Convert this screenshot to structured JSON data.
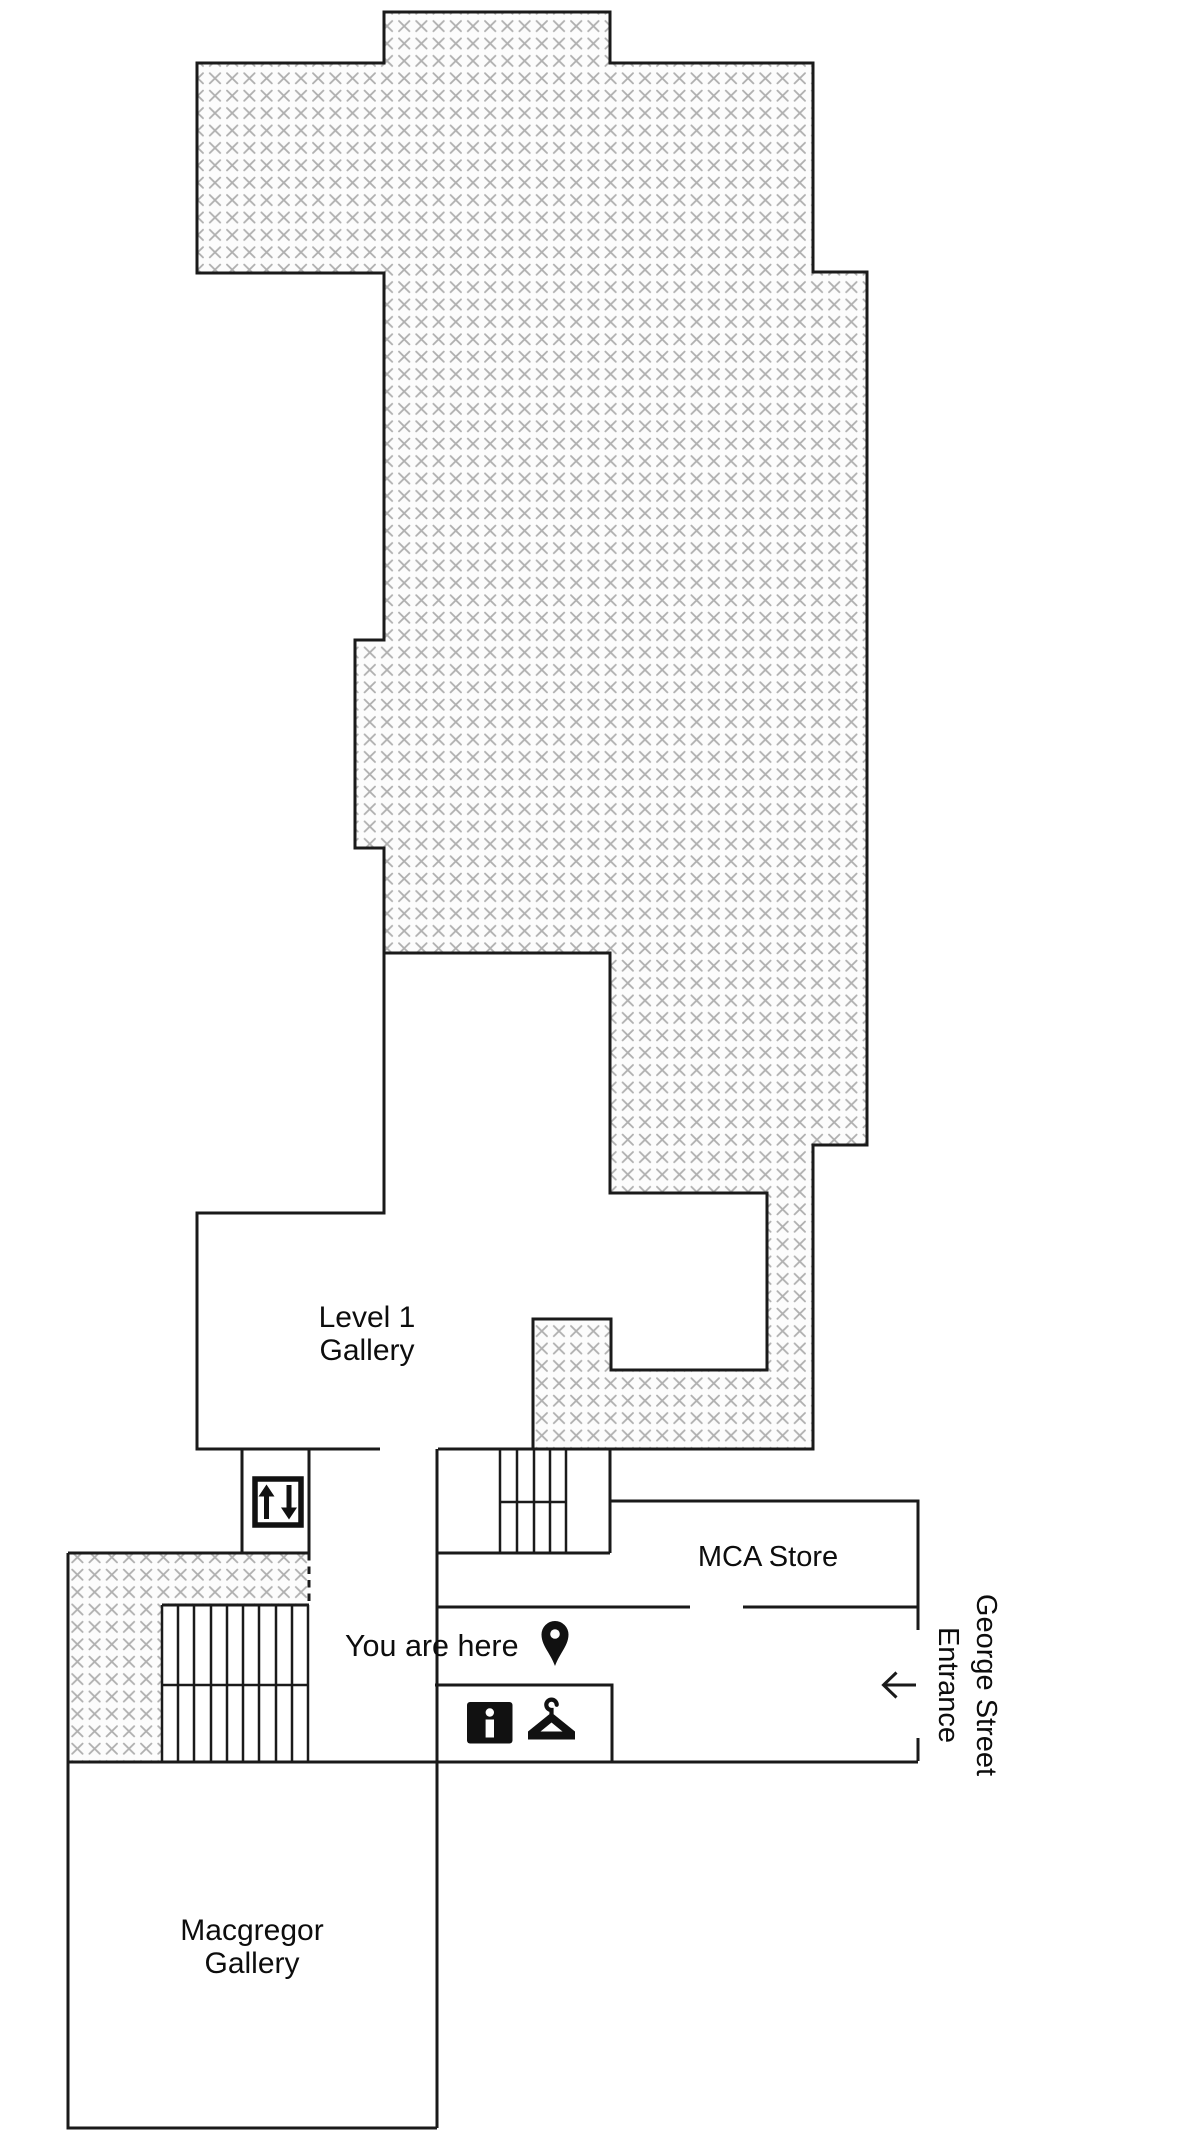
{
  "floor_map": {
    "rooms": [
      {
        "id": "level1-gallery",
        "label_line1": "Level 1",
        "label_line2": "Gallery"
      },
      {
        "id": "mca-store",
        "label": "MCA Store"
      },
      {
        "id": "macgregor-gallery",
        "label_line1": "Macgregor",
        "label_line2": "Gallery"
      }
    ],
    "markers": {
      "you_are_here": "You are here",
      "entrance_line1": "George Street",
      "entrance_line2": "Entrance"
    },
    "icons": [
      "elevator-icon",
      "location-pin-icon",
      "info-icon",
      "coat-hanger-icon",
      "left-arrow-icon",
      "stairs-left",
      "stairs-center"
    ],
    "colors": {
      "wall": "#1a1a1a",
      "hatch_mark": "#b0b0b0",
      "hatch_background": "#fcfcfc",
      "text": "#0d0d0d",
      "background": "#ffffff"
    }
  }
}
